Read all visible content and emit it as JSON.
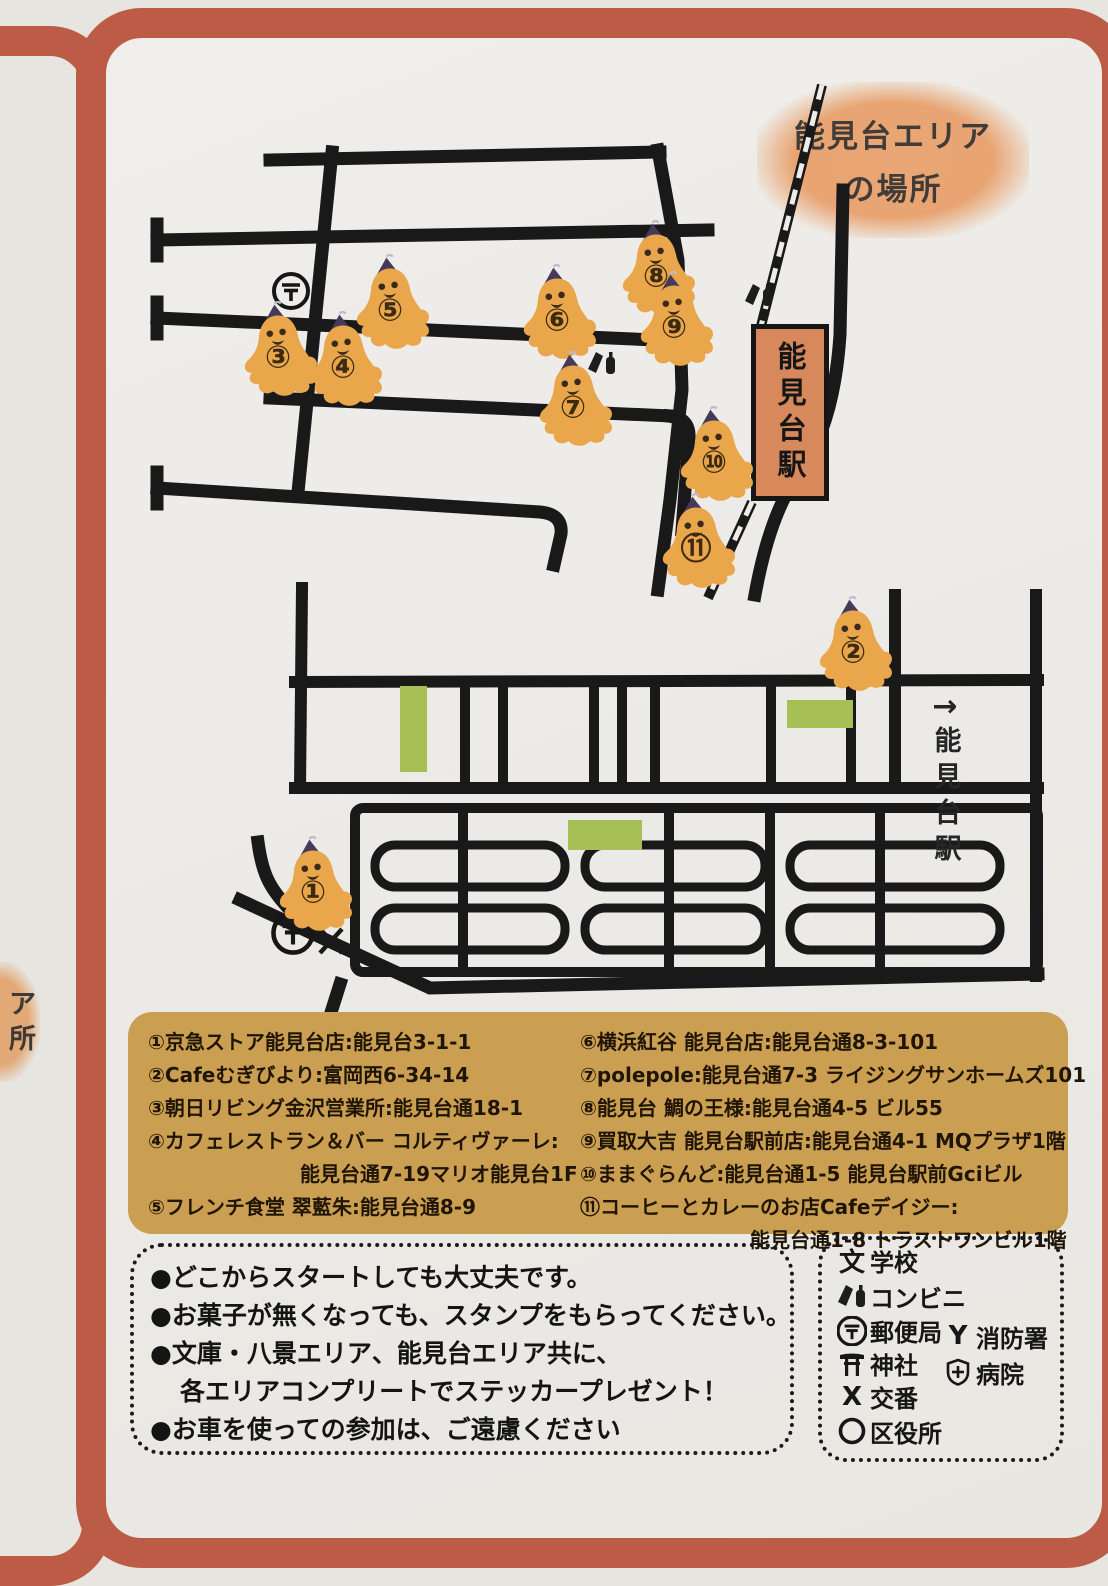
{
  "title": {
    "line1": "能見台エリア",
    "line2": "の場所"
  },
  "neighbor_card_fragment": {
    "char1": "ア",
    "char2": "所"
  },
  "map": {
    "station_sign": "能見台駅",
    "direction_label": {
      "arrow": "→",
      "text": "能見台駅"
    },
    "markers": [
      {
        "label": "①",
        "x": 313,
        "y": 888
      },
      {
        "label": "②",
        "x": 853,
        "y": 648
      },
      {
        "label": "③",
        "x": 278,
        "y": 353
      },
      {
        "label": "④",
        "x": 343,
        "y": 363
      },
      {
        "label": "⑤",
        "x": 390,
        "y": 306
      },
      {
        "label": "⑥",
        "x": 557,
        "y": 316
      },
      {
        "label": "⑦",
        "x": 573,
        "y": 403
      },
      {
        "label": "⑧",
        "x": 656,
        "y": 272
      },
      {
        "label": "⑨",
        "x": 674,
        "y": 323
      },
      {
        "label": "⑩",
        "x": 714,
        "y": 458
      },
      {
        "label": "⑪",
        "x": 696,
        "y": 545
      }
    ],
    "map_symbols": [
      "post-office-icon",
      "post-office-icon",
      "police-box-icon",
      "convenience-icon",
      "convenience-icon"
    ]
  },
  "addresses": {
    "col1": [
      {
        "text": "①京急ストア能見台店:能見台3-1-1"
      },
      {
        "text": "②Cafeむぎびより:富岡西6-34-14"
      },
      {
        "text": "③朝日リビング金沢営業所:能見台通18-1"
      },
      {
        "text": "④カフェレストラン＆バー コルティヴァーレ:",
        "line2": "能見台通7-19マリオ能見台1F"
      },
      {
        "text": "⑤フレンチ食堂 翠藍朱:能見台通8-9"
      }
    ],
    "col2": [
      {
        "text": "⑥横浜紅谷 能見台店:能見台通8-3-101"
      },
      {
        "text": "⑦polepole:能見台通7-3 ライジングサンホームズ101"
      },
      {
        "text": "⑧能見台 鯛の王様:能見台通4-5 ビル55"
      },
      {
        "text": "⑨買取大吉 能見台駅前店:能見台通4-1 MQプラザ1階"
      },
      {
        "text": "⑩ままぐらんど:能見台通1-5 能見台駅前Gciビル"
      },
      {
        "text": "⑪コーヒーとカレーのお店Cafeデイジー:",
        "line2": "能見台通1-8 トラストワンビル1階"
      }
    ]
  },
  "notes": {
    "items": [
      {
        "text": "●どこからスタートしても大丈夫です。"
      },
      {
        "text": "●お菓子が無くなっても、スタンプをもらってください。"
      },
      {
        "text": "●文庫・八景エリア、能見台エリア共に、"
      },
      {
        "text": "各エリアコンプリートでステッカープレゼント！",
        "indent": true
      },
      {
        "text": "●お車を使っての参加は、ご遠慮ください"
      }
    ]
  },
  "legend": {
    "items": [
      {
        "icon": "school-icon",
        "symbol": "文",
        "label": "学校"
      },
      {
        "icon": "convenience-icon",
        "label": "コンビニ"
      },
      {
        "icon": "post-office-icon",
        "label": "郵便局"
      },
      {
        "icon": "shrine-icon",
        "label": "神社"
      },
      {
        "icon": "police-box-icon",
        "symbol": "X",
        "label": "交番"
      },
      {
        "icon": "ward-office-icon",
        "label": "区役所"
      },
      {
        "icon": "fire-station-icon",
        "symbol": "Y",
        "label": "消防署"
      },
      {
        "icon": "hospital-icon",
        "label": "病院"
      }
    ]
  },
  "colors": {
    "card_border": "#bd5c46",
    "panel_bg": "#cb9f52",
    "ghost_orange": "#e9a64a",
    "hat_purple": "#47395a",
    "green_block": "#a7c055",
    "station_sign_bg": "#d8895c",
    "road_black": "#191919",
    "title_blob": "#e8a573"
  }
}
